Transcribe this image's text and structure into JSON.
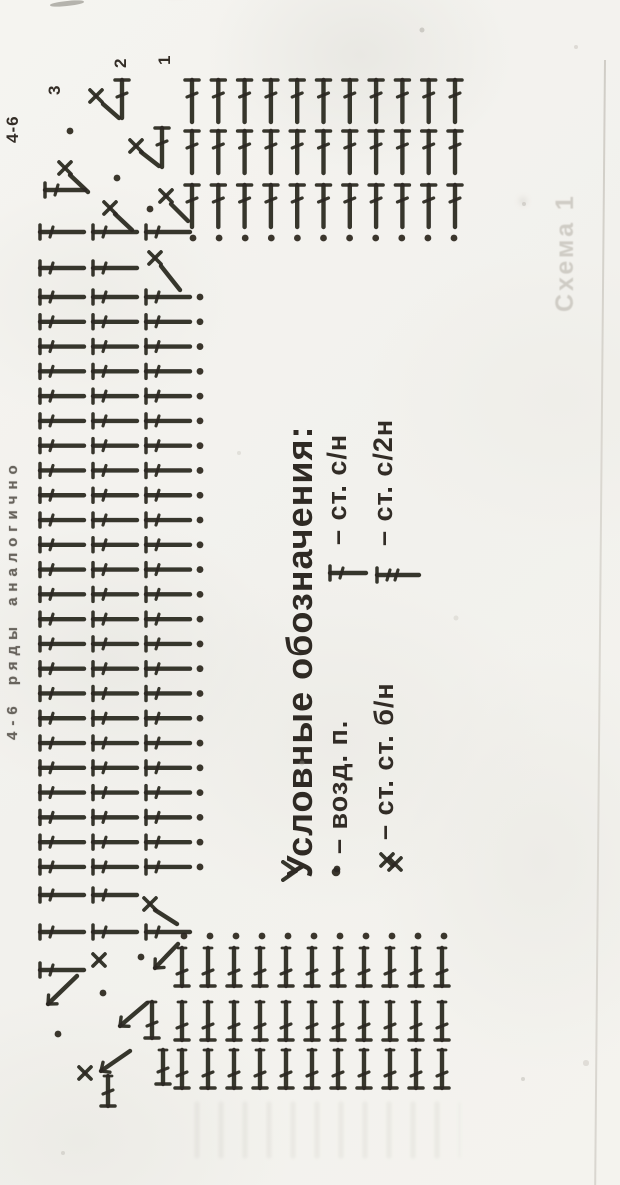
{
  "page": {
    "paper_color": "#f4f3ef",
    "ink_color": "#2b2620",
    "ghost_color": "#cfccc5"
  },
  "labels": {
    "corner_note": "4-6",
    "row_numbers": [
      "3",
      "2",
      "1"
    ],
    "side_note": "4-6 ряды аналогично",
    "ghost_text": "Схема 1"
  },
  "legend": {
    "title": "Условные обозначения:",
    "entries": [
      {
        "symbol": "chain-dot",
        "label": "– возд. п."
      },
      {
        "symbol": "double-crochet-dc",
        "label": "– ст. с/н"
      },
      {
        "symbol": "single-crochet-x",
        "label": "– ст. ст. б/н"
      },
      {
        "symbol": "treble-2yo",
        "label": "– ст. с/2н"
      }
    ]
  },
  "diagram": {
    "top_grid": {
      "cols": 11,
      "x0": 192,
      "dx": 26.3,
      "row_tops": [
        80,
        131,
        185
      ],
      "stem": 42
    },
    "top_dots": {
      "count": 11,
      "x0": 193,
      "dx": 26.1,
      "y": 238,
      "r": 3.4
    },
    "mid": {
      "xs": [
        40,
        93,
        146
      ],
      "stem": 44,
      "dot_x": 200,
      "y0": 297,
      "dy": 24.78,
      "count": 24,
      "extras": [
        {
          "y": 232,
          "n": 3
        },
        {
          "y": 268,
          "n": 2
        },
        {
          "y": 895,
          "n": 2
        },
        {
          "y": 932,
          "n": 3
        },
        {
          "y": 970,
          "n": 1
        }
      ]
    },
    "bottom_grid": {
      "cols": 11,
      "x0": 182,
      "dx": 26,
      "row_bottoms": [
        986,
        1040,
        1088
      ],
      "stem": 38
    },
    "bottom_dots": {
      "count": 11,
      "x0": 184,
      "dx": 26,
      "y": 936,
      "r": 3.4
    },
    "marks": [
      {
        "t": "x",
        "x": 96,
        "y": 96
      },
      {
        "t": "diag",
        "x1": 103,
        "y1": 104,
        "x2": 119,
        "y2": 118
      },
      {
        "t": "dc_up",
        "x": 122,
        "y": 80,
        "len": 38
      },
      {
        "t": "dot",
        "x": 70,
        "y": 131
      },
      {
        "t": "x",
        "x": 136,
        "y": 146
      },
      {
        "t": "diag",
        "x1": 141,
        "y1": 152,
        "x2": 159,
        "y2": 166
      },
      {
        "t": "dc_up",
        "x": 162,
        "y": 128,
        "len": 39
      },
      {
        "t": "dot",
        "x": 117,
        "y": 178
      },
      {
        "t": "x",
        "x": 65,
        "y": 168
      },
      {
        "t": "diag",
        "x1": 70,
        "y1": 175,
        "x2": 88,
        "y2": 192
      },
      {
        "t": "hline",
        "x": 45,
        "y": 190,
        "len": 40
      },
      {
        "t": "x",
        "x": 110,
        "y": 208
      },
      {
        "t": "diag",
        "x1": 115,
        "y1": 214,
        "x2": 132,
        "y2": 230
      },
      {
        "t": "dot",
        "x": 150,
        "y": 209
      },
      {
        "t": "x",
        "x": 166,
        "y": 196
      },
      {
        "t": "diag",
        "x1": 171,
        "y1": 204,
        "x2": 188,
        "y2": 221
      },
      {
        "t": "x",
        "x": 155,
        "y": 258
      },
      {
        "t": "diag",
        "x1": 161,
        "y1": 266,
        "x2": 180,
        "y2": 290
      },
      {
        "t": "x",
        "x": 150,
        "y": 904
      },
      {
        "t": "diag",
        "x1": 155,
        "y1": 910,
        "x2": 177,
        "y2": 924
      },
      {
        "t": "hook",
        "x": 283,
        "y": 871
      },
      {
        "t": "dot",
        "x": 337,
        "y": 869
      },
      {
        "t": "x",
        "x": 395,
        "y": 864
      },
      {
        "t": "x",
        "x": 99,
        "y": 960
      },
      {
        "t": "dot",
        "x": 141,
        "y": 957
      },
      {
        "t": "diag_a",
        "x1": 178,
        "y1": 944,
        "x2": 155,
        "y2": 968
      },
      {
        "t": "diag_a",
        "x1": 77,
        "y1": 976,
        "x2": 48,
        "y2": 1004
      },
      {
        "t": "dot",
        "x": 103,
        "y": 993
      },
      {
        "t": "diag_a",
        "x1": 147,
        "y1": 1003,
        "x2": 120,
        "y2": 1026
      },
      {
        "t": "dc_down",
        "x": 152,
        "y": 1038,
        "len": 36
      },
      {
        "t": "dot",
        "x": 58,
        "y": 1034
      },
      {
        "t": "diag_a",
        "x1": 130,
        "y1": 1051,
        "x2": 101,
        "y2": 1071
      },
      {
        "t": "x",
        "x": 85,
        "y": 1073
      },
      {
        "t": "dc_down",
        "x": 108,
        "y": 1106,
        "len": 30
      },
      {
        "t": "dc_down",
        "x": 163,
        "y": 1084,
        "len": 34
      },
      {
        "t": "dot",
        "x": 336,
        "y": 872,
        "r": 4.3
      },
      {
        "t": "hline",
        "x": 330,
        "y": 573,
        "len": 36
      },
      {
        "t": "x",
        "x": 387,
        "y": 860
      },
      {
        "t": "hline2",
        "x": 377,
        "y": 575,
        "len": 42
      }
    ]
  }
}
